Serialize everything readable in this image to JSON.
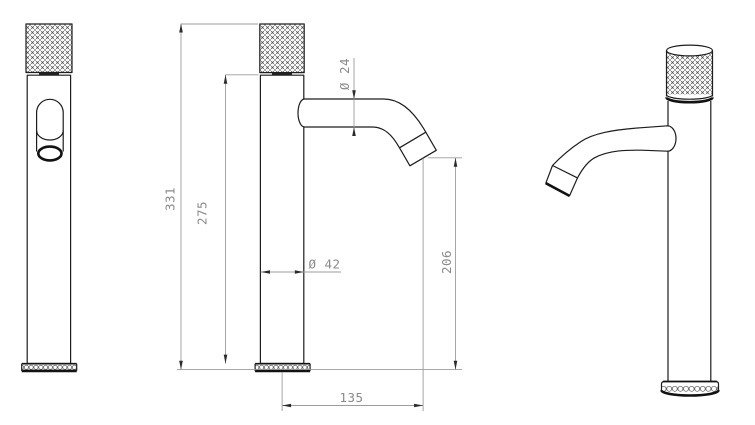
{
  "drawing": {
    "dimensions": {
      "overall_height": "331",
      "body_height": "275",
      "spout_diameter": "Ø 24",
      "body_diameter": "Ø 42",
      "outlet_height": "206",
      "spout_reach": "135"
    },
    "colors": {
      "object_line": "#1d1d1d",
      "dimension_line": "#9c9c9c",
      "dimension_text": "#8a8a8a",
      "background": "#ffffff"
    }
  }
}
